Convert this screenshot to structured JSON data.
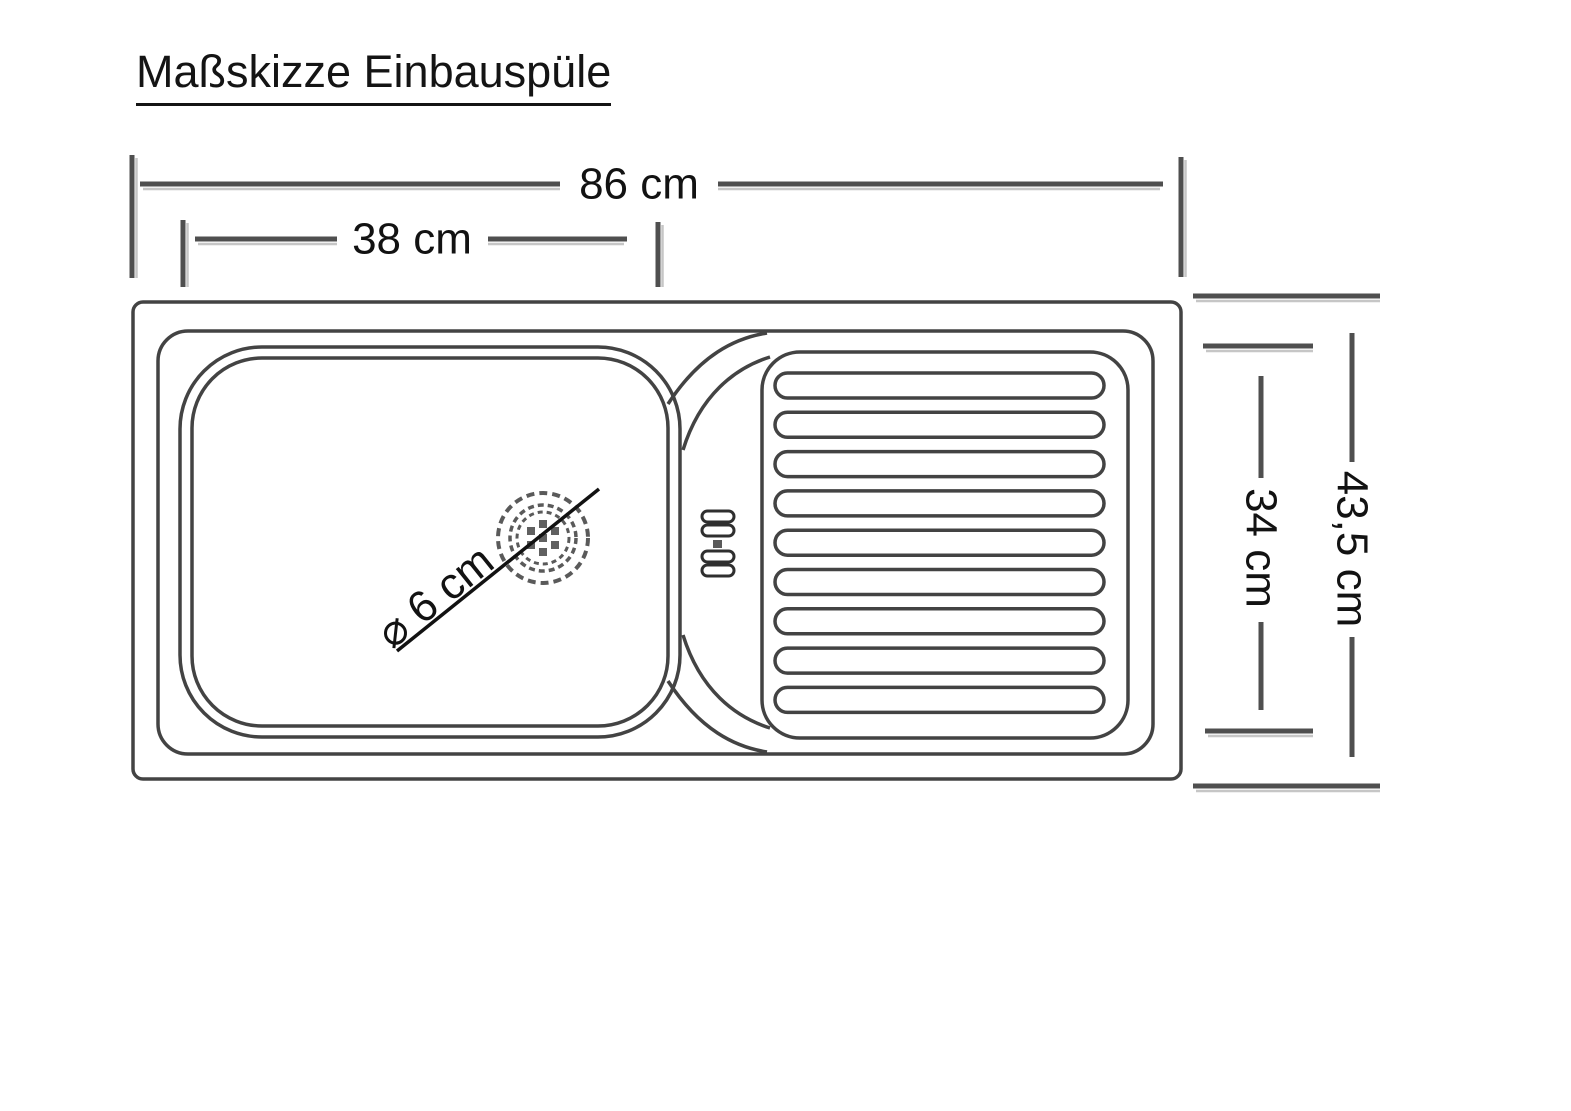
{
  "title": {
    "text": "Maßskizze Einbauspüle"
  },
  "sketch": {
    "object": "Einbauspüle (built-in kitchen sink), top view technical sketch",
    "labels": {
      "overall_width": "86 cm",
      "basin_width": "38 cm",
      "overall_depth": "43,5 cm",
      "inner_depth": "34 cm",
      "drain_diameter": "⌀ 6 cm"
    },
    "measurements_cm": {
      "overall_width": 86,
      "basin_width": 38,
      "overall_depth": 43.5,
      "inner_depth": 34,
      "drain_diameter": 6
    },
    "drainboard_rib_count": 9,
    "colors": {
      "outline": "#434343",
      "dimension_line": "#4f4f4f",
      "text": "#121212",
      "background": "#ffffff"
    }
  }
}
